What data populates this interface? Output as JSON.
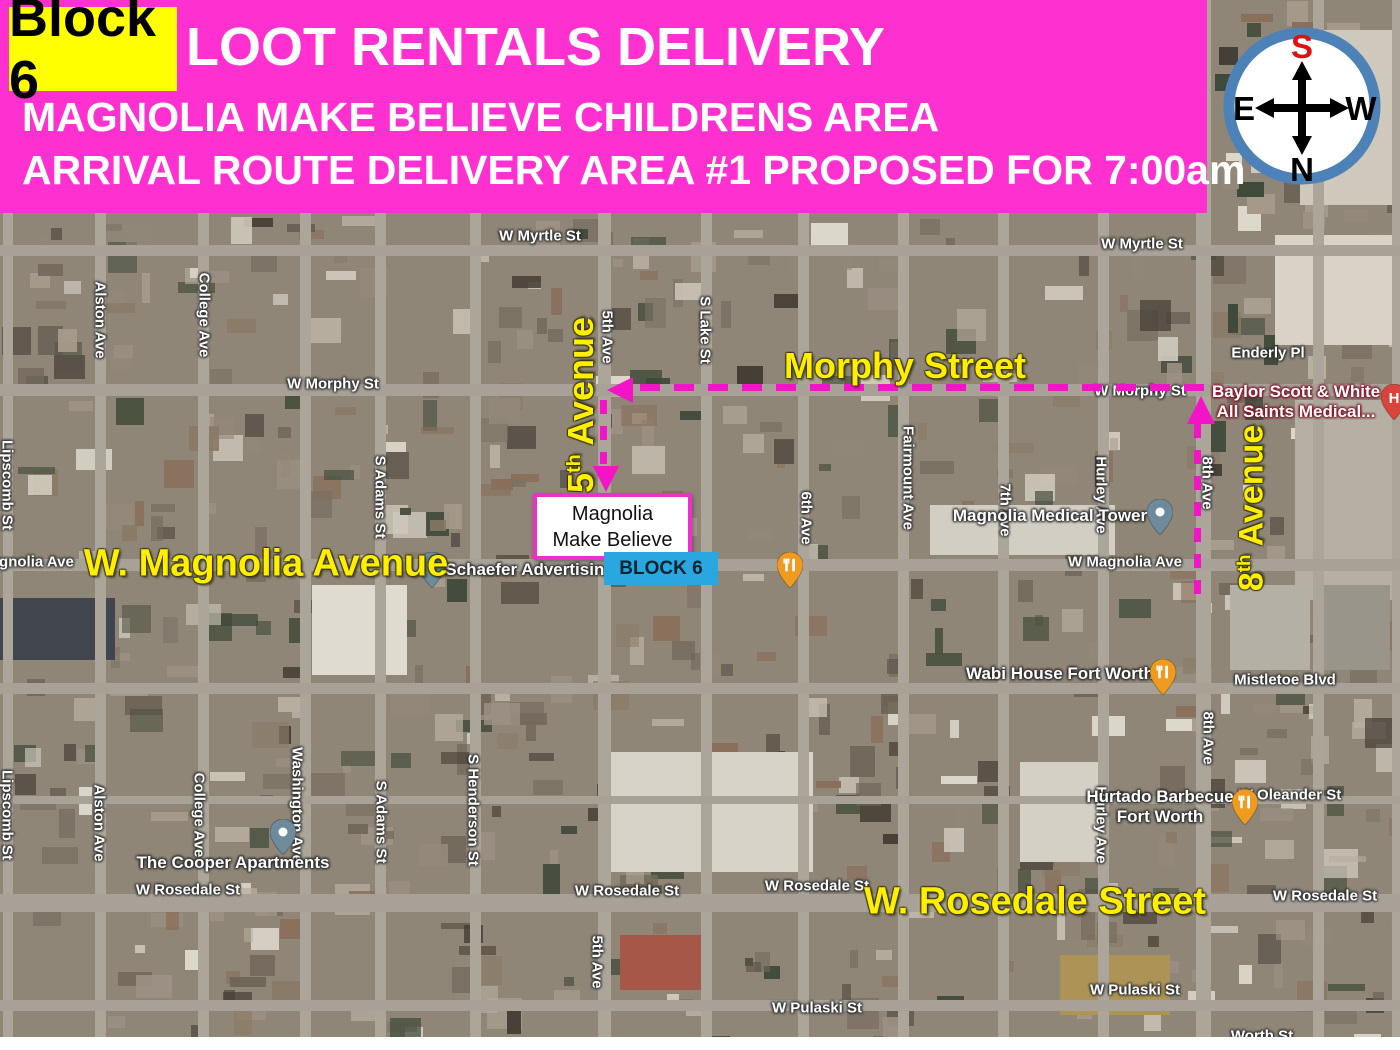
{
  "header": {
    "block_label": "Block 6",
    "title": "LOOT RENTALS DELIVERY",
    "subtitle1": "MAGNOLIA MAKE BELIEVE CHILDRENS AREA",
    "subtitle2": "ARRIVAL ROUTE DELIVERY AREA #1 PROPOSED FOR 7:00am",
    "bg_color": "#ff30d0",
    "highlight_color": "#ffff00"
  },
  "compass": {
    "top": "S",
    "bottom": "N",
    "left": "E",
    "right": "W",
    "top_color": "#e01010",
    "letter_color": "#000000",
    "ring_color": "#4d82b8"
  },
  "overlay": {
    "route_color": "#f414c8",
    "yellow_labels": [
      {
        "text": "Morphy Street",
        "x": 905,
        "y": 366,
        "rot": 0,
        "size": 36
      },
      {
        "num": "5",
        "sup": "th",
        "rest": " Avenue",
        "x": 581,
        "y": 405,
        "rot": -90,
        "size": 36
      },
      {
        "num": "8",
        "sup": "th",
        "rest": " Avenue",
        "x": 1252,
        "y": 508,
        "rot": -90,
        "size": 34
      },
      {
        "text": "W. Magnolia Avenue",
        "x": 266,
        "y": 564,
        "rot": 0,
        "size": 38
      },
      {
        "text": "W. Rosedale Street",
        "x": 1035,
        "y": 902,
        "rot": 0,
        "size": 38
      }
    ],
    "route": {
      "segments": [
        {
          "type": "h",
          "x1": 640,
          "x2": 1208,
          "y": 387
        },
        {
          "type": "v",
          "x": 603,
          "y1": 400,
          "y2": 464
        },
        {
          "type": "v",
          "x": 1197,
          "y1": 424,
          "y2": 596
        }
      ],
      "arrows": [
        {
          "dir": "left",
          "x": 607,
          "y": 390
        },
        {
          "dir": "down",
          "x": 606,
          "y": 492
        },
        {
          "dir": "up",
          "x": 1201,
          "y": 396
        }
      ]
    },
    "destination_box": {
      "line1": "Magnolia",
      "line2": "Make Believe",
      "border_color": "#ee2fc9"
    },
    "block_box": {
      "text": "BLOCK 6",
      "bg_color": "#29a7e0"
    }
  },
  "map": {
    "street_labels": [
      {
        "text": "W Myrtle St",
        "x": 540,
        "y": 236,
        "rot": 0
      },
      {
        "text": "W Myrtle St",
        "x": 1142,
        "y": 244,
        "rot": 0
      },
      {
        "text": "Alston Ave",
        "x": 100,
        "y": 320,
        "rot": 90
      },
      {
        "text": "College Ave",
        "x": 204,
        "y": 315,
        "rot": 90
      },
      {
        "text": "W Morphy St",
        "x": 333,
        "y": 384,
        "rot": 0
      },
      {
        "text": "5th Ave",
        "x": 607,
        "y": 337,
        "rot": 90
      },
      {
        "text": "S Lake St",
        "x": 705,
        "y": 330,
        "rot": 90
      },
      {
        "text": "W Morphy St",
        "x": 1140,
        "y": 391,
        "rot": 0
      },
      {
        "text": "Enderly Pl",
        "x": 1268,
        "y": 353,
        "rot": 0
      },
      {
        "text": "Fairmount Ave",
        "x": 908,
        "y": 478,
        "rot": 90
      },
      {
        "text": "7th Ave",
        "x": 1005,
        "y": 510,
        "rot": 90
      },
      {
        "text": "Hurley Ave",
        "x": 1101,
        "y": 495,
        "rot": 90
      },
      {
        "text": "8th Ave",
        "x": 1207,
        "y": 483,
        "rot": 90
      },
      {
        "text": "Magnolia Ave",
        "x": 26,
        "y": 562,
        "rot": 0
      },
      {
        "text": "W Magnolia Ave",
        "x": 1125,
        "y": 562,
        "rot": 0
      },
      {
        "text": "6th Ave",
        "x": 806,
        "y": 518,
        "rot": 90
      },
      {
        "text": "S Adams St",
        "x": 380,
        "y": 497,
        "rot": 90
      },
      {
        "text": "Lipscomb St",
        "x": 7,
        "y": 485,
        "rot": 90
      },
      {
        "text": "Mistletoe Blvd",
        "x": 1285,
        "y": 680,
        "rot": 0
      },
      {
        "text": "8th Ave",
        "x": 1208,
        "y": 738,
        "rot": 90
      },
      {
        "text": "W Oleander St",
        "x": 1290,
        "y": 795,
        "rot": 0
      },
      {
        "text": "Hurley Ave",
        "x": 1101,
        "y": 825,
        "rot": 90
      },
      {
        "text": "Lipscomb St",
        "x": 7,
        "y": 815,
        "rot": 90
      },
      {
        "text": "Alston Ave",
        "x": 99,
        "y": 823,
        "rot": 90
      },
      {
        "text": "College Ave",
        "x": 199,
        "y": 815,
        "rot": 90
      },
      {
        "text": "Washington Ave",
        "x": 297,
        "y": 805,
        "rot": 90
      },
      {
        "text": "S Adams St",
        "x": 381,
        "y": 822,
        "rot": 90
      },
      {
        "text": "S Henderson St",
        "x": 473,
        "y": 810,
        "rot": 90
      },
      {
        "text": "W Rosedale St",
        "x": 188,
        "y": 890,
        "rot": 0
      },
      {
        "text": "W Rosedale St",
        "x": 627,
        "y": 891,
        "rot": 0
      },
      {
        "text": "W Rosedale St",
        "x": 817,
        "y": 886,
        "rot": 0
      },
      {
        "text": "W Rosedale St",
        "x": 1325,
        "y": 896,
        "rot": 0
      },
      {
        "text": "5th Ave",
        "x": 597,
        "y": 962,
        "rot": 90
      },
      {
        "text": "W Pulaski St",
        "x": 817,
        "y": 1008,
        "rot": 0
      },
      {
        "text": "W Pulaski St",
        "x": 1135,
        "y": 990,
        "rot": 0
      },
      {
        "text": "Worth St",
        "x": 1262,
        "y": 1036,
        "rot": 0
      }
    ],
    "poi_labels": [
      {
        "lines": [
          "Schaefer Advertising"
        ],
        "x": 530,
        "y": 570,
        "style": "plain"
      },
      {
        "lines": [
          "Magnolia Medical Tower"
        ],
        "x": 1050,
        "y": 516,
        "style": "plain"
      },
      {
        "lines": [
          "Wabi House Fort Worth"
        ],
        "x": 1060,
        "y": 674,
        "style": "plain"
      },
      {
        "lines": [
          "Hurtado Barbecue",
          "Fort Worth"
        ],
        "x": 1160,
        "y": 807,
        "style": "plain"
      },
      {
        "lines": [
          "The Cooper Apartments"
        ],
        "x": 233,
        "y": 863,
        "style": "plain"
      },
      {
        "lines": [
          "Baylor Scott & White",
          "All Saints Medical..."
        ],
        "x": 1296,
        "y": 402,
        "style": "hospital"
      }
    ],
    "pins": [
      {
        "type": "place",
        "x": 432,
        "y": 588
      },
      {
        "type": "place",
        "x": 1160,
        "y": 535
      },
      {
        "type": "place",
        "x": 283,
        "y": 855
      },
      {
        "type": "restaurant",
        "x": 790,
        "y": 588
      },
      {
        "type": "restaurant",
        "x": 1163,
        "y": 695
      },
      {
        "type": "restaurant",
        "x": 1245,
        "y": 825
      },
      {
        "type": "hospital",
        "x": 1394,
        "y": 420
      }
    ],
    "pin_colors": {
      "place": "#6d8b9c",
      "restaurant": "#ef9b20",
      "hospital": "#d9453c"
    }
  }
}
